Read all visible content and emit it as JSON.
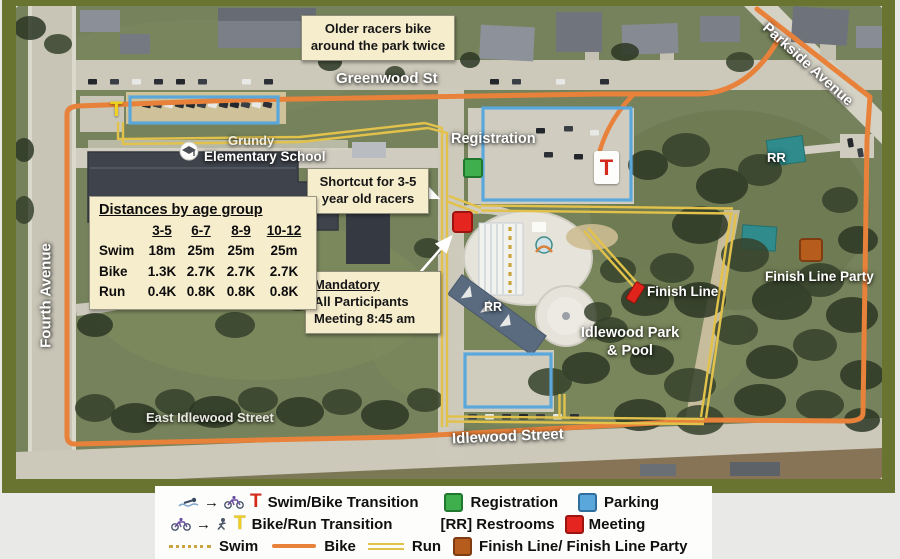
{
  "map": {
    "street_labels": {
      "greenwood": "Greenwood St",
      "parkside": "Parkside Avenue",
      "fourth": "Fourth Avenue",
      "east_idlewood": "East Idlewood Street",
      "idlewood": "Idlewood Street"
    },
    "place_labels": {
      "school_line1": "Grundy",
      "school_line2": "Elementary School",
      "registration": "Registration",
      "rr_north": "RR",
      "rr_pool": "RR",
      "finish_line": "Finish Line",
      "finish_line_party": "Finish Line Party",
      "park_line1": "Idlewood Park",
      "park_line2": "& Pool"
    },
    "markers": {
      "swim_bike_t": "T",
      "bike_run_t": "T"
    },
    "callouts": {
      "older": {
        "line1": "Older racers bike",
        "line2": "around the park twice"
      },
      "shortcut": {
        "line1": "Shortcut for 3-5",
        "line2": "year old racers"
      },
      "mandatory": {
        "line1": "Mandatory",
        "line2": "All Participants",
        "line3": "Meeting 8:45 am"
      }
    },
    "distances": {
      "title": "Distances by age group",
      "columns": [
        "3-5",
        "6-7",
        "8-9",
        "10-12"
      ],
      "rows": [
        {
          "label": "Swim",
          "values": [
            "18m",
            "25m",
            "25m",
            "25m"
          ]
        },
        {
          "label": "Bike",
          "values": [
            "1.3K",
            "2.7K",
            "2.7K",
            "2.7K"
          ]
        },
        {
          "label": "Run",
          "values": [
            "0.4K",
            "0.8K",
            "0.8K",
            "0.8K"
          ]
        }
      ]
    }
  },
  "legend": {
    "row1": {
      "arrow": "→",
      "t": "T",
      "label": "Swim/Bike Transition",
      "registration": "Registration",
      "parking": "Parking"
    },
    "row2": {
      "arrow": "→",
      "t": "T",
      "label": "Bike/Run Transition",
      "restrooms": "[RR] Restrooms",
      "meeting": "Meeting"
    },
    "row3": {
      "swim": "Swim",
      "bike": "Bike",
      "run": "Run",
      "finish": "Finish Line/ Finish Line Party"
    }
  },
  "colors": {
    "border_olive": "#6a7431",
    "bike_route": "#e8813a",
    "run_route": "#e3c24b",
    "swim_route": "#c9a53e",
    "parking_box": "#5aa7dc",
    "registration_marker": "#3fae4c",
    "meeting_marker": "#e52620",
    "finish_marker": "#b65c1d",
    "transition_red_t": "#d42a1e",
    "transition_yellow_t": "#f2d21f"
  }
}
